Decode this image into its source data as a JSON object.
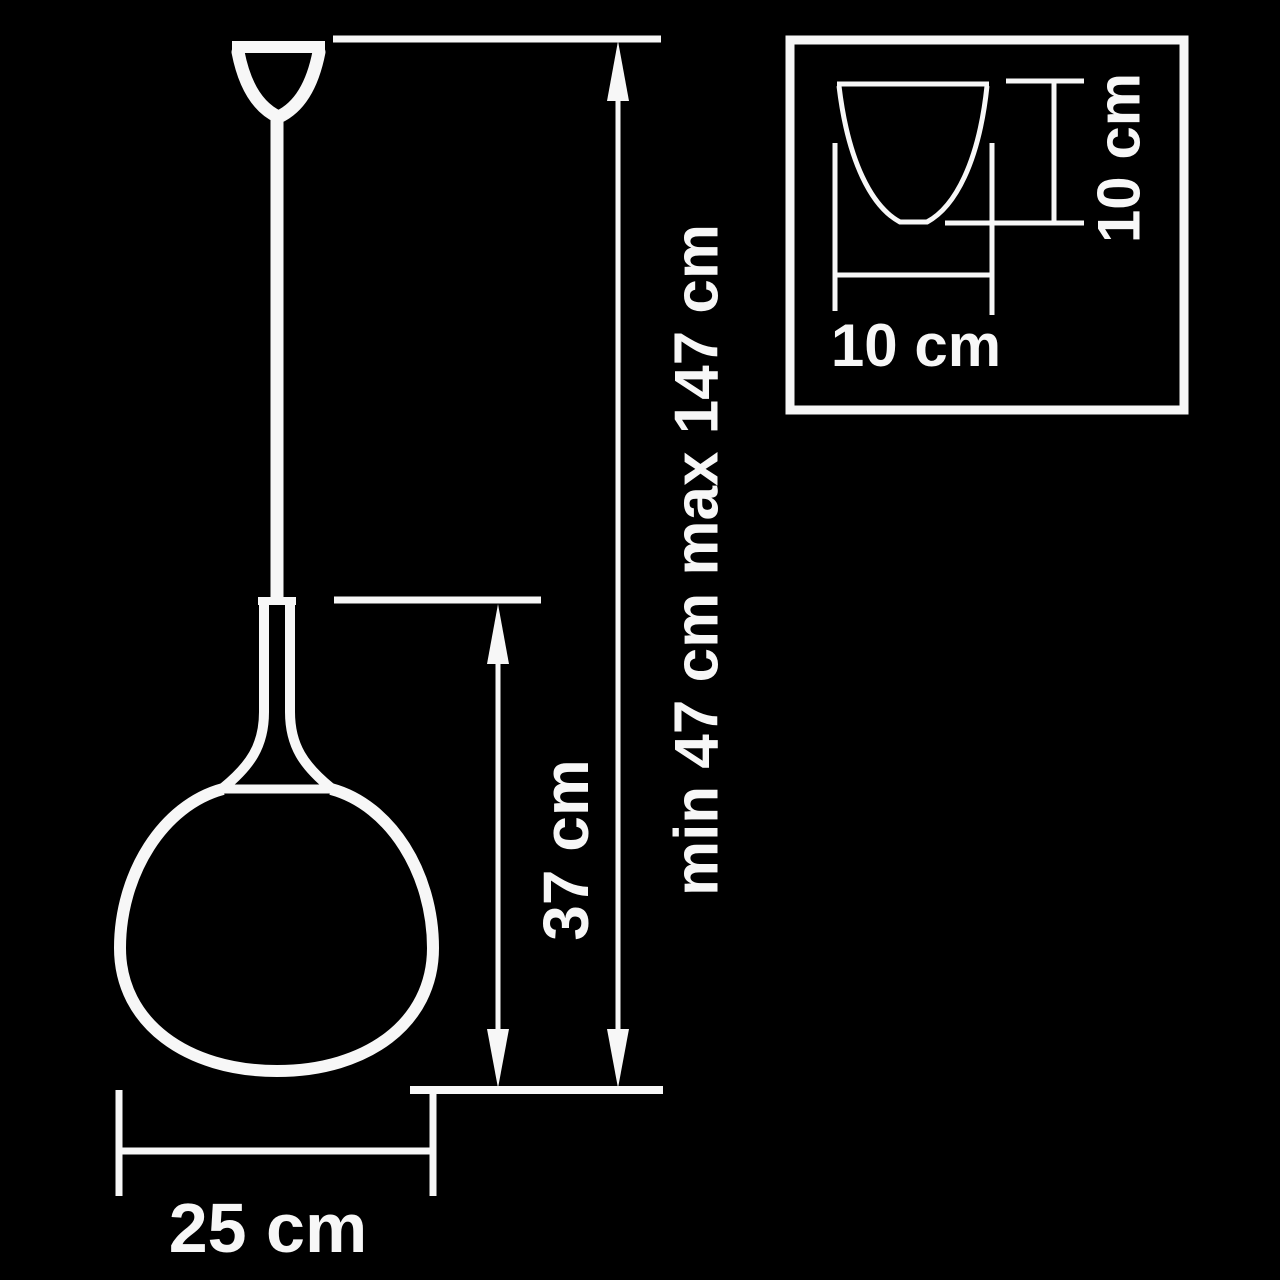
{
  "colors": {
    "background": "#000000",
    "line": "#f7f7f7",
    "text": "#f7f7f7"
  },
  "main_view": {
    "labels": {
      "suspension_height": "min 47 cm max 147 cm",
      "shade_height": "37 cm",
      "shade_diameter": "25 cm"
    }
  },
  "inset_view": {
    "labels": {
      "canopy_width": "10 cm",
      "canopy_height": "10 cm"
    }
  }
}
